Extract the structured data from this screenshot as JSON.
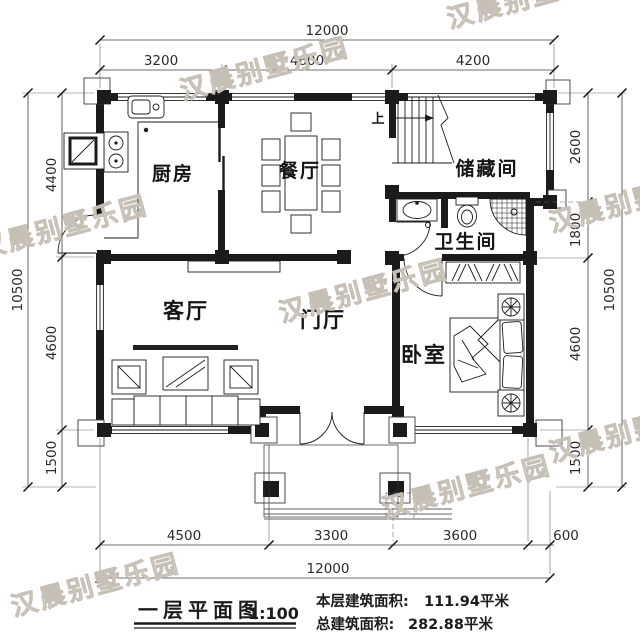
{
  "plan": {
    "rooms": {
      "kitchen": "厨房",
      "dining": "餐厅",
      "storage": "储藏间",
      "bathroom": "卫生间",
      "living": "客厅",
      "foyer": "门厅",
      "bedroom": "卧室"
    },
    "stairs_up_label": "上"
  },
  "dimensions": {
    "top": {
      "total": "12000",
      "segments": [
        "3200",
        "4600",
        "4200"
      ]
    },
    "bottom": {
      "total": "12000",
      "segments": [
        "4500",
        "3300",
        "3600",
        "600"
      ]
    },
    "left": {
      "total": "10500",
      "segments": [
        "4400",
        "4600",
        "1500"
      ]
    },
    "right": {
      "total": "10500",
      "segments": [
        "2600",
        "1800",
        "4600",
        "1500"
      ]
    }
  },
  "title_block": {
    "title": "一层平面图",
    "scale": "1:100",
    "floor_area_label": "本层建筑面积:",
    "floor_area_value": "111.94平米",
    "total_area_label": "总建筑面积:",
    "total_area_value": "282.88平米"
  },
  "watermark": {
    "text": "汉晨别墅乐园",
    "color": "#d9d3cb"
  },
  "colors": {
    "ink": "#1b1b1b",
    "dimension": "#3c3c3c",
    "background": "#ffffff"
  }
}
